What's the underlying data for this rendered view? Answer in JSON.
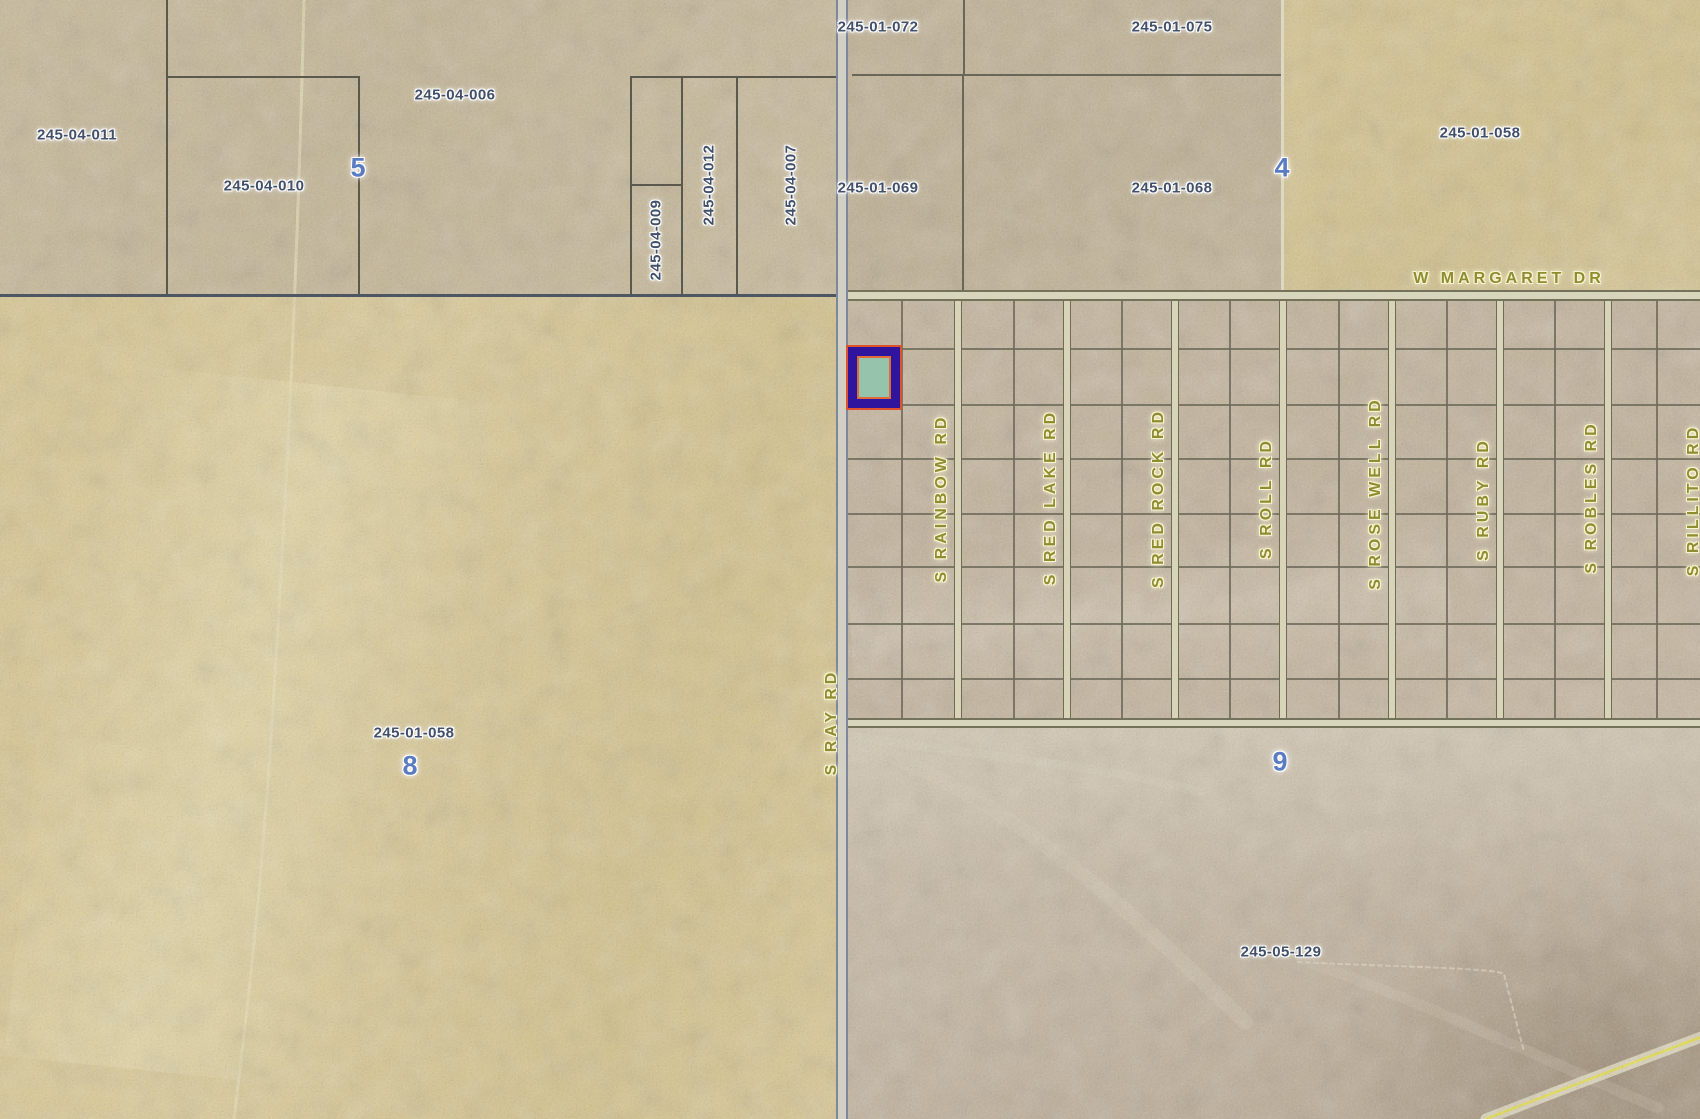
{
  "map": {
    "kind": "county-parcel-map",
    "parcel_labels": [
      {
        "text": "245-04-011",
        "x": 77,
        "y": 135,
        "vertical": false
      },
      {
        "text": "245-04-010",
        "x": 264,
        "y": 186,
        "vertical": false
      },
      {
        "text": "245-04-006",
        "x": 455,
        "y": 95,
        "vertical": false
      },
      {
        "text": "245-04-009",
        "x": 656,
        "y": 240,
        "vertical": true
      },
      {
        "text": "245-04-012",
        "x": 709,
        "y": 185,
        "vertical": true
      },
      {
        "text": "245-04-007",
        "x": 791,
        "y": 185,
        "vertical": true
      },
      {
        "text": "245-01-072",
        "x": 878,
        "y": 27,
        "vertical": false
      },
      {
        "text": "245-01-075",
        "x": 1172,
        "y": 27,
        "vertical": false
      },
      {
        "text": "245-01-069",
        "x": 878,
        "y": 188,
        "vertical": false
      },
      {
        "text": "245-01-068",
        "x": 1172,
        "y": 188,
        "vertical": false
      },
      {
        "text": "245-01-058",
        "x": 1480,
        "y": 133,
        "vertical": false
      },
      {
        "text": "245-01-058",
        "x": 414,
        "y": 733,
        "vertical": false
      },
      {
        "text": "245-05-129",
        "x": 1281,
        "y": 952,
        "vertical": false
      }
    ],
    "section_numbers": [
      {
        "text": "5",
        "x": 358,
        "y": 168
      },
      {
        "text": "4",
        "x": 1282,
        "y": 168
      },
      {
        "text": "8",
        "x": 410,
        "y": 766
      },
      {
        "text": "9",
        "x": 1280,
        "y": 762
      }
    ],
    "road_labels": [
      {
        "text": "W MARGARET DR",
        "x": 1509,
        "y": 279,
        "vertical": false
      },
      {
        "text": "S RAY RD",
        "x": 832,
        "y": 722,
        "vertical": true
      },
      {
        "text": "S RAINBOW RD",
        "x": 942,
        "y": 498,
        "vertical": true
      },
      {
        "text": "S RED LAKE RD",
        "x": 1051,
        "y": 497,
        "vertical": true
      },
      {
        "text": "S RED ROCK RD",
        "x": 1159,
        "y": 498,
        "vertical": true
      },
      {
        "text": "S ROLL RD",
        "x": 1267,
        "y": 498,
        "vertical": true
      },
      {
        "text": "S ROSE WELL RD",
        "x": 1376,
        "y": 493,
        "vertical": true
      },
      {
        "text": "S RUBY RD",
        "x": 1484,
        "y": 499,
        "vertical": true
      },
      {
        "text": "S ROBLES RD",
        "x": 1592,
        "y": 497,
        "vertical": true
      },
      {
        "text": "S RILLITO RD",
        "x": 1694,
        "y": 500,
        "vertical": true
      }
    ],
    "selected_parcel": {
      "x": 846,
      "y": 345,
      "width": 56,
      "height": 65
    },
    "colors": {
      "highlight_outer": "#df512c",
      "highlight_band": "#2f159e",
      "highlight_inner": "#e06a3a",
      "highlight_fill": "#96c3ab",
      "parcel_label": "#42506a",
      "section_label": "#5b7cc2",
      "road_label": "#8f8c31",
      "section_line": "#4e5663",
      "parcel_line": "#5b594d",
      "street_fill": "#d7d4ba"
    },
    "geometry": {
      "regions": [
        {
          "name": "section-5-terrain",
          "x": 0,
          "y": 0,
          "w": 846,
          "h": 296,
          "bg": "linear-gradient(115deg,#c9b997 0%,#c5b593 45%,#cabb9a 100%)"
        },
        {
          "name": "section-4-parcels-terrain",
          "x": 846,
          "y": 0,
          "w": 436,
          "h": 296,
          "bg": "linear-gradient(160deg,#c3b394 0%,#bfb091 60%,#c4b496 100%)"
        },
        {
          "name": "section-4-east-terrain",
          "x": 1282,
          "y": 0,
          "w": 418,
          "h": 296,
          "bg": "linear-gradient(140deg,#d8c68e 0%,#d4c289 60%,#d9c893 100%)"
        },
        {
          "name": "section-8-terrain",
          "x": 0,
          "y": 296,
          "w": 846,
          "h": 823,
          "bg": "linear-gradient(105deg,#dac88f 0%,#ddcc96 40%,#d5c389 75%,#dbc992 100%)"
        },
        {
          "name": "section-8-wash-streak",
          "x": 40,
          "y": 380,
          "w": 430,
          "h": 700,
          "bg": "linear-gradient(100deg,rgba(238,226,180,0) 5%,rgba(238,226,180,0.45) 45%,rgba(238,226,180,0) 80%)",
          "transform": "rotate(6deg)"
        },
        {
          "name": "subdivision-terrain",
          "x": 846,
          "y": 296,
          "w": 854,
          "h": 430,
          "bg": "linear-gradient(170deg,#c6b69c 0%,#c2b299 55%,#c8b8a0 100%)"
        },
        {
          "name": "subdivision-wash",
          "x": 850,
          "y": 540,
          "w": 600,
          "h": 140,
          "bg": "linear-gradient(180deg,rgba(216,204,182,0) 0%,rgba(216,204,182,0.5) 50%,rgba(216,204,182,0) 100%)",
          "transform": "rotate(-4deg)"
        },
        {
          "name": "section-9-terrain",
          "x": 846,
          "y": 726,
          "w": 854,
          "h": 393,
          "bg": "linear-gradient(160deg,#cabca5 0%,#c6b8a1 40%,#bcac94 75%,#b1a088 100%)"
        },
        {
          "name": "section-9-upper-wash",
          "x": 846,
          "y": 726,
          "w": 854,
          "h": 170,
          "bg": "linear-gradient(180deg,rgba(224,214,194,0.5) 0%,rgba(224,214,194,0) 100%)"
        },
        {
          "name": "section-9-hill-shade",
          "x": 1330,
          "y": 880,
          "w": 370,
          "h": 239,
          "bg": "radial-gradient(ellipse at 72% 78%,rgba(134,114,88,0.5) 0%,rgba(134,114,88,0) 68%)"
        }
      ],
      "lines": [
        {
          "name": "parcel-line",
          "x": 166,
          "y": 0,
          "w": 2,
          "h": 296,
          "c": "#5b594d"
        },
        {
          "name": "parcel-line",
          "x": 166,
          "y": 76,
          "w": 194,
          "h": 2,
          "c": "#5b594d"
        },
        {
          "name": "parcel-line",
          "x": 358,
          "y": 76,
          "w": 2,
          "h": 220,
          "c": "#5b594d"
        },
        {
          "name": "parcel-line",
          "x": 630,
          "y": 76,
          "w": 216,
          "h": 2,
          "c": "#5b594d"
        },
        {
          "name": "parcel-line",
          "x": 630,
          "y": 76,
          "w": 2,
          "h": 220,
          "c": "#5b594d"
        },
        {
          "name": "parcel-line",
          "x": 681,
          "y": 76,
          "w": 2,
          "h": 220,
          "c": "#5b594d"
        },
        {
          "name": "parcel-line",
          "x": 736,
          "y": 76,
          "w": 2,
          "h": 220,
          "c": "#5b594d"
        },
        {
          "name": "parcel-line",
          "x": 630,
          "y": 184,
          "w": 53,
          "h": 2,
          "c": "#5b594d"
        },
        {
          "name": "parcel-line",
          "x": 852,
          "y": 74,
          "w": 430,
          "h": 2,
          "c": "#6a675a"
        },
        {
          "name": "parcel-line",
          "x": 963,
          "y": 0,
          "w": 2,
          "h": 76,
          "c": "#6a675a"
        },
        {
          "name": "parcel-line",
          "x": 962,
          "y": 74,
          "w": 2,
          "h": 222,
          "c": "#6a675a"
        },
        {
          "name": "section-edge-light",
          "x": 1281,
          "y": 0,
          "w": 3,
          "h": 296,
          "c": "#ddd8c2"
        },
        {
          "name": "section-line",
          "x": 0,
          "y": 294,
          "w": 838,
          "h": 3,
          "c": "#4e5663"
        }
      ],
      "roads": {
        "ns": {
          "x": 836,
          "y": 0,
          "w": 12,
          "h": 1119
        },
        "margaret": {
          "x": 848,
          "y": 290,
          "w": 852,
          "h": 11
        },
        "south_grid": {
          "x": 848,
          "y": 718,
          "w": 852,
          "h": 10
        },
        "street_centers": [
          958,
          1067,
          1175,
          1283,
          1392,
          1500,
          1608
        ],
        "street_width": 8,
        "street_top": 301,
        "street_bottom": 718
      },
      "grid": {
        "left": 848,
        "right": 1700,
        "top": 301,
        "bottom": 718,
        "rows": [
          348,
          404,
          458,
          513,
          566,
          623,
          678
        ]
      },
      "paths": [
        {
          "name": "dirt-trail",
          "d": "M304,0 C298,260 286,520 268,780 C258,920 246,1020 234,1119",
          "stroke": "#eadfb6",
          "w": 3,
          "o": 0.7
        },
        {
          "name": "wash",
          "d": "M856,742 C1000,792 1120,900 1245,1022",
          "stroke": "#dbcfb8",
          "w": 15,
          "o": 0.28
        },
        {
          "name": "wash",
          "d": "M1302,960 C1420,1000 1540,1058 1658,1108",
          "stroke": "#dbcfb8",
          "w": 11,
          "o": 0.22
        },
        {
          "name": "wash",
          "d": "M856,650 C1000,612 1200,632 1392,562",
          "stroke": "#d6cab3",
          "w": 18,
          "o": 0.2
        },
        {
          "name": "wash",
          "d": "M856,736 C950,754 1080,760 1200,792",
          "stroke": "#e0d6c0",
          "w": 9,
          "o": 0.25
        },
        {
          "name": "old-boundary-trace",
          "d": "M1298,962 C1400,967 1495,968 1504,974 L1524,1052",
          "stroke": "#e8dfca",
          "w": 2,
          "o": 0.6,
          "dash": "4,4"
        },
        {
          "name": "road-corridor",
          "d": "M1486,1119 C1560,1090 1640,1060 1704,1036",
          "stroke": "#e6e1c4",
          "w": 11,
          "o": 0.85
        },
        {
          "name": "road-centerline-yellow",
          "d": "M1486,1119 C1560,1090 1640,1060 1704,1036",
          "stroke": "#e9e23e",
          "w": 2.5,
          "o": 0.95
        }
      ]
    }
  }
}
